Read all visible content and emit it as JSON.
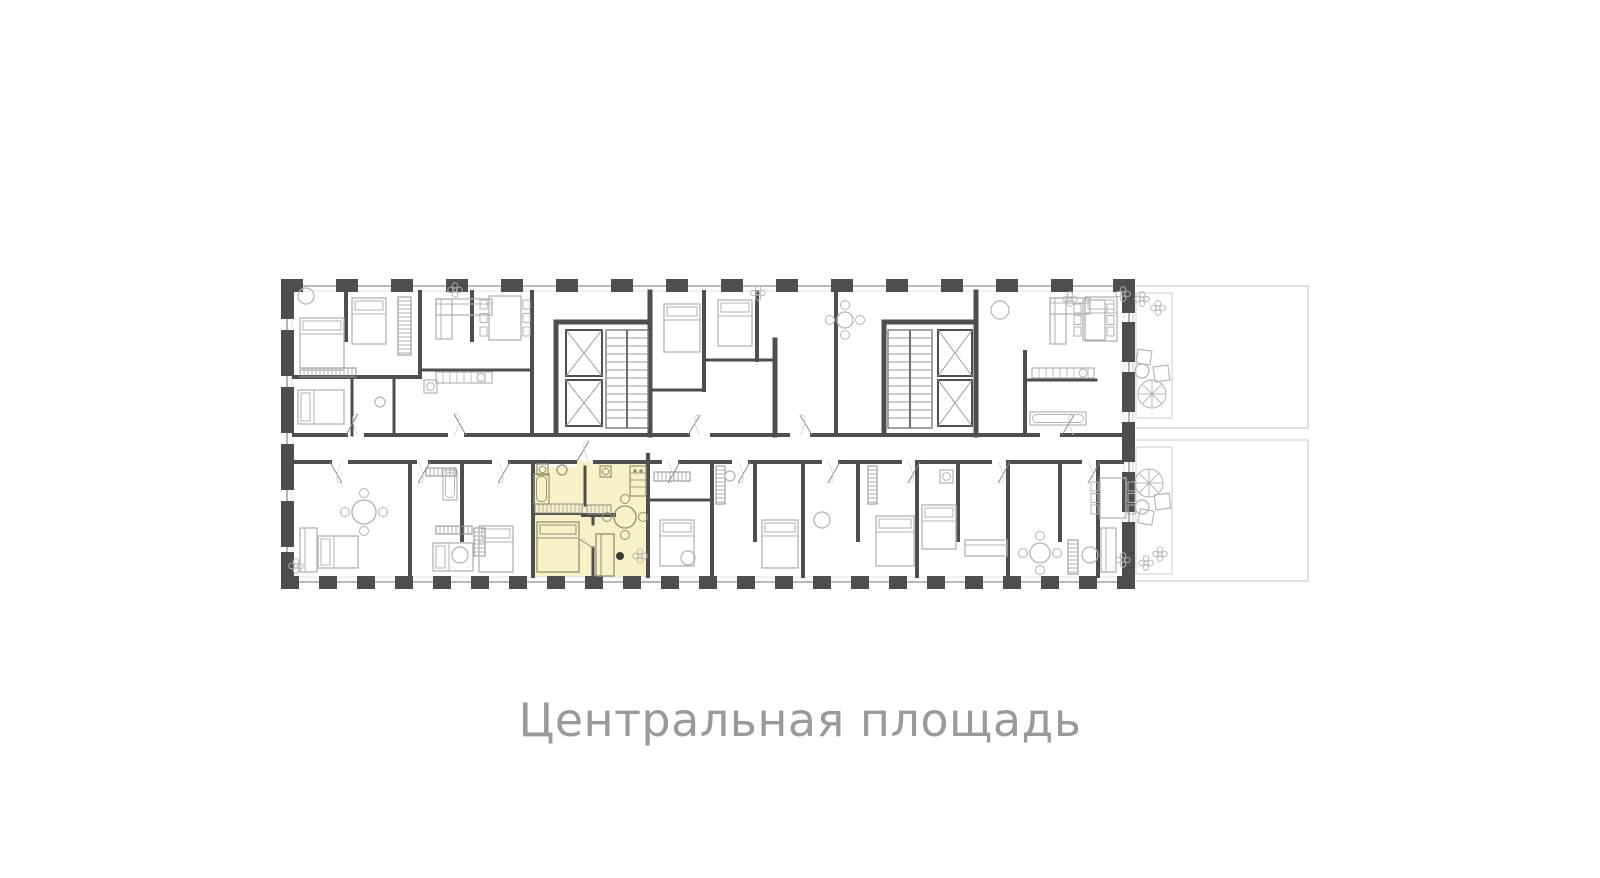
{
  "page": {
    "background": "#ffffff"
  },
  "caption": {
    "text": "Центральная площадь",
    "color": "#9a9a9a"
  },
  "plan": {
    "colors": {
      "wall": "#4e4e4e",
      "outline": "#8f8f8f",
      "outline_light": "#e0e0e0",
      "furniture": "#b3b3b3",
      "furniture_dark": "#908f76",
      "terrace": "#cfcfcf",
      "highlight_fill": "#f9f2c6",
      "door": "#8a8a8a",
      "dot": "#3c3c3c"
    },
    "building": {
      "left": 281,
      "top": 279,
      "right": 1135,
      "bottom": 589
    },
    "outline_lines": [
      [
        281,
        286,
        1135,
        286
      ],
      [
        281,
        582,
        1135,
        582
      ],
      [
        287,
        292,
        287,
        576
      ],
      [
        1129,
        292,
        1129,
        576
      ]
    ],
    "outline_lines_light": [
      [
        294,
        291,
        1122,
        291
      ],
      [
        294,
        577,
        1122,
        577
      ],
      [
        292,
        292,
        292,
        576
      ],
      [
        1124,
        292,
        1124,
        576
      ]
    ],
    "piers": {
      "top": {
        "y": 279,
        "h": 13,
        "w": 22,
        "xs": [
          281,
          336,
          391,
          446,
          501,
          556,
          611,
          666,
          721,
          776,
          831,
          886,
          941,
          996,
          1051,
          1113
        ]
      },
      "bottom": {
        "y": 576,
        "h": 13,
        "w": 18,
        "xs": [
          281,
          319,
          357,
          395,
          433,
          471,
          509,
          547,
          585,
          623,
          661,
          699,
          737,
          775,
          813,
          851,
          889,
          927,
          965,
          1003,
          1041,
          1079,
          1117
        ]
      },
      "left": {
        "x": 281,
        "w": 13,
        "items": [
          [
            279,
            40
          ],
          [
            330,
            46
          ],
          [
            387,
            46
          ],
          [
            444,
            46
          ],
          [
            501,
            46
          ],
          [
            552,
            37
          ]
        ]
      },
      "right": {
        "x": 1122,
        "w": 13,
        "items": [
          [
            279,
            34
          ],
          [
            322,
            40
          ],
          [
            372,
            40
          ],
          [
            422,
            40
          ],
          [
            472,
            40
          ],
          [
            522,
            40
          ],
          [
            562,
            27
          ]
        ]
      }
    },
    "highlight_points": "533,467 577,467 577,461 648,461 648,577 533,577",
    "walls": [
      [
        346,
        292,
        346,
        340,
        4
      ],
      [
        420,
        292,
        420,
        377,
        4
      ],
      [
        294,
        377,
        420,
        377,
        4
      ],
      [
        472,
        292,
        472,
        340,
        4
      ],
      [
        532,
        292,
        532,
        435,
        4
      ],
      [
        420,
        370,
        532,
        370,
        3
      ],
      [
        352,
        377,
        352,
        435,
        3
      ],
      [
        394,
        377,
        394,
        435,
        3
      ],
      [
        556,
        322,
        650,
        322,
        5
      ],
      [
        556,
        322,
        556,
        432,
        5
      ],
      [
        650,
        292,
        650,
        435,
        5
      ],
      [
        884,
        322,
        976,
        322,
        5
      ],
      [
        884,
        322,
        884,
        432,
        5
      ],
      [
        976,
        292,
        976,
        435,
        5
      ],
      [
        704,
        292,
        704,
        390,
        4
      ],
      [
        650,
        390,
        704,
        390,
        3
      ],
      [
        757,
        292,
        757,
        360,
        4
      ],
      [
        704,
        360,
        775,
        360,
        3
      ],
      [
        775,
        340,
        775,
        435,
        5
      ],
      [
        836,
        292,
        836,
        435,
        4
      ],
      [
        1025,
        352,
        1025,
        435,
        4
      ],
      [
        1025,
        380,
        1096,
        380,
        3
      ],
      [
        294,
        435,
        346,
        435,
        4
      ],
      [
        366,
        435,
        446,
        435,
        4
      ],
      [
        466,
        435,
        688,
        435,
        4
      ],
      [
        712,
        435,
        788,
        435,
        4
      ],
      [
        812,
        435,
        1038,
        435,
        4
      ],
      [
        1062,
        435,
        1122,
        435,
        4
      ],
      [
        294,
        462,
        330,
        462,
        4
      ],
      [
        350,
        462,
        415,
        462,
        4
      ],
      [
        430,
        462,
        490,
        462,
        4
      ],
      [
        510,
        462,
        575,
        462,
        4
      ],
      [
        595,
        462,
        660,
        462,
        4
      ],
      [
        680,
        462,
        730,
        462,
        4
      ],
      [
        750,
        462,
        820,
        462,
        4
      ],
      [
        840,
        462,
        900,
        462,
        4
      ],
      [
        920,
        462,
        990,
        462,
        4
      ],
      [
        1010,
        462,
        1080,
        462,
        4
      ],
      [
        1100,
        462,
        1122,
        462,
        4
      ],
      [
        410,
        462,
        410,
        576,
        4
      ],
      [
        462,
        462,
        462,
        540,
        4
      ],
      [
        533,
        462,
        533,
        576,
        4
      ],
      [
        648,
        455,
        648,
        576,
        4
      ],
      [
        712,
        462,
        712,
        576,
        4
      ],
      [
        755,
        462,
        755,
        540,
        4
      ],
      [
        803,
        462,
        803,
        576,
        4
      ],
      [
        858,
        462,
        858,
        540,
        4
      ],
      [
        917,
        462,
        917,
        576,
        4
      ],
      [
        958,
        462,
        958,
        540,
        4
      ],
      [
        1008,
        462,
        1008,
        576,
        4
      ],
      [
        1060,
        462,
        1060,
        540,
        4
      ],
      [
        1098,
        462,
        1098,
        576,
        4
      ],
      [
        648,
        500,
        712,
        500,
        3
      ],
      [
        585,
        467,
        585,
        505,
        3
      ],
      [
        533,
        514,
        583,
        514,
        2
      ],
      [
        583,
        515,
        614,
        515,
        4
      ],
      [
        593,
        515,
        593,
        524,
        3
      ],
      [
        593,
        548,
        593,
        576,
        3
      ]
    ],
    "elevators": [
      [
        566,
        330,
        36,
        46
      ],
      [
        566,
        380,
        36,
        46
      ],
      [
        938,
        330,
        34,
        46
      ],
      [
        938,
        380,
        34,
        46
      ]
    ],
    "stairs": [
      [
        606,
        330,
        42,
        98
      ],
      [
        888,
        330,
        44,
        98
      ]
    ],
    "hatches": [
      [
        535,
        504,
        47,
        9
      ],
      [
        587,
        505,
        24,
        9
      ],
      [
        398,
        297,
        13,
        58
      ],
      [
        300,
        368,
        56,
        9
      ],
      [
        654,
        472,
        36,
        9
      ],
      [
        716,
        466,
        9,
        38
      ],
      [
        868,
        466,
        9,
        38
      ],
      [
        1068,
        540,
        10,
        34
      ],
      [
        436,
        526,
        36,
        8
      ],
      [
        474,
        528,
        11,
        28
      ],
      [
        426,
        468,
        30,
        8
      ]
    ],
    "doors": [
      [
        346,
        435,
        358,
        414
      ],
      [
        466,
        435,
        454,
        414
      ],
      [
        688,
        435,
        700,
        415
      ],
      [
        812,
        435,
        800,
        415
      ],
      [
        1062,
        435,
        1074,
        415
      ],
      [
        330,
        462,
        342,
        483
      ],
      [
        430,
        462,
        418,
        483
      ],
      [
        510,
        462,
        498,
        483
      ],
      [
        577,
        461,
        589,
        441
      ],
      [
        680,
        462,
        668,
        483
      ],
      [
        750,
        462,
        738,
        483
      ],
      [
        840,
        462,
        828,
        483
      ],
      [
        920,
        462,
        908,
        483
      ],
      [
        1010,
        462,
        998,
        483
      ],
      [
        1100,
        462,
        1088,
        483
      ],
      [
        593,
        548,
        578,
        538
      ]
    ],
    "furniture": [
      {
        "t": "bed",
        "x": 300,
        "y": 318,
        "w": 44,
        "h": 52,
        "head": "n"
      },
      {
        "t": "bed",
        "x": 352,
        "y": 298,
        "w": 34,
        "h": 46,
        "head": "n"
      },
      {
        "t": "bed",
        "x": 298,
        "y": 390,
        "w": 46,
        "h": 34,
        "head": "w"
      },
      {
        "t": "bed",
        "x": 318,
        "y": 536,
        "w": 40,
        "h": 32,
        "head": "w"
      },
      {
        "t": "bed",
        "x": 433,
        "y": 543,
        "w": 40,
        "h": 28,
        "head": "w"
      },
      {
        "t": "bed",
        "x": 479,
        "y": 526,
        "w": 34,
        "h": 46,
        "head": "n"
      },
      {
        "t": "bed",
        "x": 664,
        "y": 304,
        "w": 36,
        "h": 48,
        "head": "n"
      },
      {
        "t": "bed",
        "x": 718,
        "y": 300,
        "w": 34,
        "h": 46,
        "head": "n"
      },
      {
        "t": "bed",
        "x": 660,
        "y": 520,
        "w": 34,
        "h": 46,
        "head": "n"
      },
      {
        "t": "bed",
        "x": 762,
        "y": 520,
        "w": 36,
        "h": 48,
        "head": "n"
      },
      {
        "t": "bed",
        "x": 876,
        "y": 516,
        "w": 38,
        "h": 50,
        "head": "n"
      },
      {
        "t": "bed",
        "x": 922,
        "y": 505,
        "w": 34,
        "h": 44,
        "head": "n"
      },
      {
        "t": "bed",
        "x": 1085,
        "y": 297,
        "w": 32,
        "h": 44,
        "head": "n"
      },
      {
        "t": "bed",
        "x": 537,
        "y": 522,
        "w": 42,
        "h": 50,
        "head": "n",
        "dark": true
      },
      {
        "t": "sofa",
        "x": 436,
        "y": 299,
        "w": 56,
        "h": 16
      },
      {
        "t": "sofa",
        "x": 436,
        "y": 299,
        "w": 16,
        "h": 40
      },
      {
        "t": "sofa",
        "x": 1050,
        "y": 298,
        "w": 40,
        "h": 16
      },
      {
        "t": "sofa",
        "x": 1050,
        "y": 298,
        "w": 16,
        "h": 46
      },
      {
        "t": "sofa",
        "x": 300,
        "y": 528,
        "w": 17,
        "h": 44
      },
      {
        "t": "sofa",
        "x": 596,
        "y": 534,
        "w": 18,
        "h": 42,
        "dark": true
      },
      {
        "t": "sofa",
        "x": 965,
        "y": 540,
        "w": 42,
        "h": 16
      },
      {
        "t": "sofa",
        "x": 1101,
        "y": 528,
        "w": 15,
        "h": 44
      },
      {
        "t": "rtable",
        "cx": 625,
        "cy": 517,
        "r": 11,
        "dark": true
      },
      {
        "t": "rtable",
        "cx": 364,
        "cy": 512,
        "r": 12
      },
      {
        "t": "rtable",
        "cx": 1040,
        "cy": 553,
        "r": 10
      },
      {
        "t": "rtable",
        "cx": 845,
        "cy": 320,
        "r": 8
      },
      {
        "t": "table6",
        "x": 489,
        "y": 296,
        "w": 32,
        "h": 44
      },
      {
        "t": "table6",
        "x": 1083,
        "y": 300,
        "w": 22,
        "h": 40
      },
      {
        "t": "table6",
        "x": 1100,
        "y": 478,
        "w": 26,
        "h": 40
      },
      {
        "t": "kitchen",
        "x": 436,
        "y": 372,
        "w": 56,
        "h": 11
      },
      {
        "t": "kitchen",
        "x": 1032,
        "y": 368,
        "w": 62,
        "h": 10
      },
      {
        "t": "vkitchen",
        "x": 630,
        "y": 466,
        "w": 16,
        "h": 30,
        "dark": true
      },
      {
        "t": "wm",
        "x": 600,
        "y": 466,
        "w": 11,
        "h": 11,
        "dark": true
      },
      {
        "t": "wm",
        "x": 537,
        "y": 464,
        "w": 11,
        "h": 11,
        "dark": true
      },
      {
        "t": "wm",
        "x": 424,
        "y": 380,
        "w": 13,
        "h": 13
      },
      {
        "t": "wm",
        "x": 940,
        "y": 470,
        "w": 13,
        "h": 13
      },
      {
        "t": "tub",
        "x": 534,
        "y": 474,
        "w": 15,
        "h": 30,
        "dark": true
      },
      {
        "t": "tub",
        "x": 443,
        "y": 470,
        "w": 14,
        "h": 30
      },
      {
        "t": "tub",
        "x": 1030,
        "y": 412,
        "w": 56,
        "h": 13
      },
      {
        "t": "circ",
        "cx": 306,
        "cy": 296,
        "r": 8
      },
      {
        "t": "circ",
        "cx": 562,
        "cy": 470,
        "r": 5,
        "dark": true
      },
      {
        "t": "circ",
        "cx": 460,
        "cy": 555,
        "r": 8
      },
      {
        "t": "circ",
        "cx": 688,
        "cy": 558,
        "r": 7
      },
      {
        "t": "circ",
        "cx": 822,
        "cy": 520,
        "r": 8
      },
      {
        "t": "circ",
        "cx": 1000,
        "cy": 310,
        "r": 9
      },
      {
        "t": "circ",
        "cx": 1090,
        "cy": 555,
        "r": 8
      },
      {
        "t": "circ",
        "cx": 380,
        "cy": 402,
        "r": 5
      },
      {
        "t": "circ",
        "cx": 730,
        "cy": 476,
        "r": 5
      },
      {
        "t": "flower",
        "cx": 455,
        "cy": 290
      },
      {
        "t": "flower",
        "cx": 758,
        "cy": 293
      },
      {
        "t": "flower",
        "cx": 296,
        "cy": 566
      },
      {
        "t": "flower",
        "cx": 640,
        "cy": 556
      },
      {
        "t": "flower",
        "cx": 1070,
        "cy": 299
      },
      {
        "t": "dot",
        "cx": 620,
        "cy": 556,
        "r": 4
      }
    ],
    "terrace": {
      "outers": [
        [
          1133,
          286,
          175,
          142
        ],
        [
          1133,
          440,
          175,
          141
        ]
      ],
      "inners": [
        [
          1136,
          293,
          36,
          125
        ],
        [
          1136,
          447,
          36,
          127
        ]
      ],
      "items": [
        {
          "t": "parasol",
          "cx": 1152,
          "cy": 394,
          "r": 14
        },
        {
          "t": "parasol",
          "cx": 1149,
          "cy": 483,
          "r": 14
        },
        {
          "t": "square",
          "x": 1137,
          "y": 350,
          "w": 14,
          "h": 14,
          "rot": 8
        },
        {
          "t": "square",
          "x": 1154,
          "y": 366,
          "w": 15,
          "h": 15,
          "rot": -8
        },
        {
          "t": "square",
          "x": 1139,
          "y": 510,
          "w": 14,
          "h": 14,
          "rot": 10
        },
        {
          "t": "square",
          "x": 1155,
          "y": 494,
          "w": 15,
          "h": 15,
          "rot": -6
        },
        {
          "t": "circ",
          "cx": 1142,
          "cy": 371,
          "r": 7
        },
        {
          "t": "circ",
          "cx": 1142,
          "cy": 507,
          "r": 7
        },
        {
          "t": "flower",
          "cx": 1142,
          "cy": 299
        },
        {
          "t": "flower",
          "cx": 1158,
          "cy": 308
        },
        {
          "t": "flower",
          "cx": 1146,
          "cy": 563
        },
        {
          "t": "flower",
          "cx": 1160,
          "cy": 554
        },
        {
          "t": "flower",
          "cx": 1123,
          "cy": 294
        },
        {
          "t": "flower",
          "cx": 1123,
          "cy": 560
        }
      ]
    }
  }
}
